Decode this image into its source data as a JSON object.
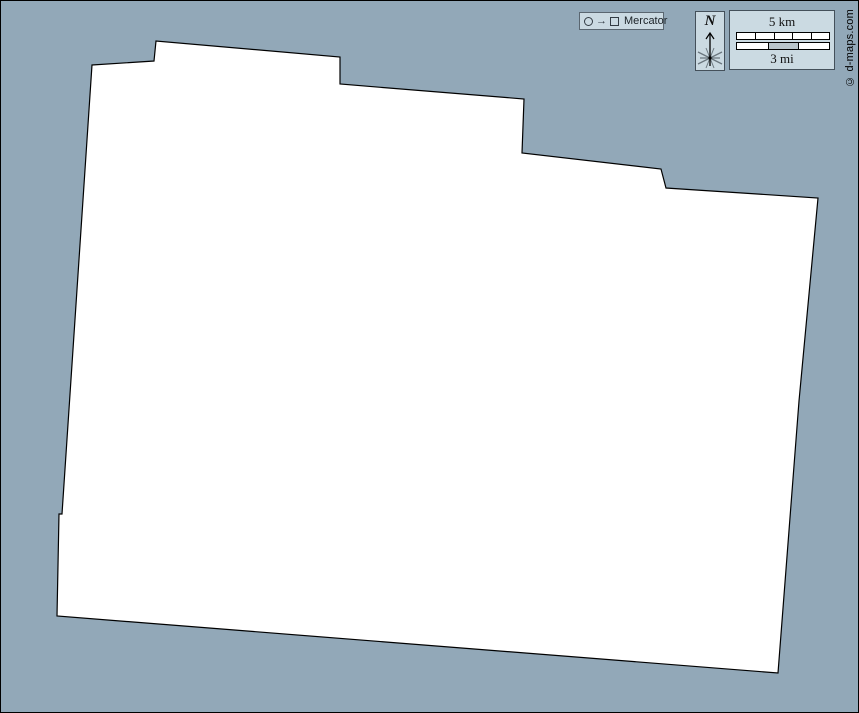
{
  "map": {
    "background_color": "#92a8b8",
    "region_fill": "#ffffff",
    "region_outline": "#000000",
    "polygon_points": "91,64 153,60 155,40 339,56 339,83 523,98 521,152 660,168 665,187 817,197 798,400 777,672 56,615 58,513 61,513"
  },
  "projection_box": {
    "label": "Mercator",
    "icons": {
      "circle": "circle-outline",
      "arrow": "→",
      "square": "square-outline"
    }
  },
  "compass": {
    "north_label": "N"
  },
  "scale_bar": {
    "km_label": "5 km",
    "mi_label": "3 mi",
    "km_segments": 5,
    "mi_segments": 3,
    "panel_color": "#cbdae2"
  },
  "copyright": {
    "text": "© d-maps.com"
  }
}
